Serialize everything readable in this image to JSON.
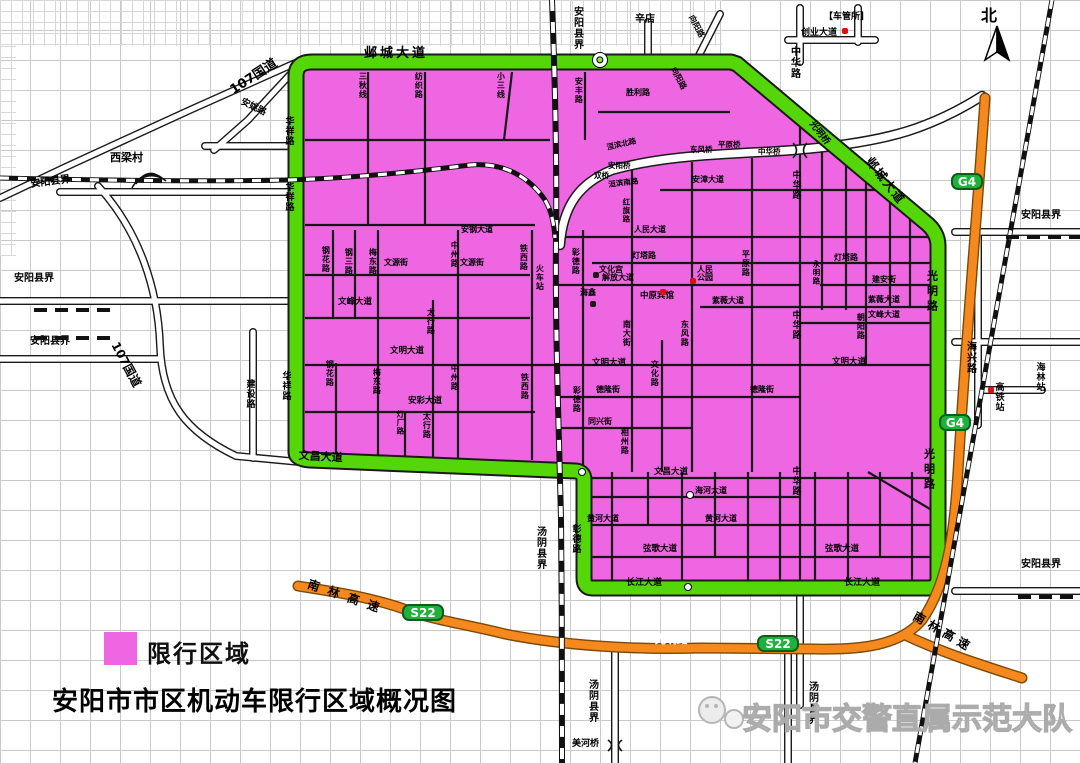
{
  "page": {
    "title": "安阳市市区机动车限行区域概况图",
    "legend_label": "限行区域",
    "watermark": "安阳市交警直属示范大队"
  },
  "colors": {
    "restricted_zone": "#ee66e2",
    "boundary_road_green": "#55d608",
    "highway_orange": "#f6891e",
    "badge_green": "#1eb23c",
    "railway_black": "#111111",
    "grid_gray": "#c9c9c9",
    "poi_red": "#dd1111"
  },
  "map": {
    "labels": [
      {
        "t": "107国道",
        "x": 228,
        "y": 86,
        "s": 13,
        "r": -33
      },
      {
        "t": "安姚路",
        "x": 243,
        "y": 98,
        "s": 9,
        "r": 26
      },
      {
        "t": "西梁村",
        "x": 110,
        "y": 152,
        "s": 11
      },
      {
        "t": "安阳县界",
        "x": 30,
        "y": 180,
        "s": 10,
        "r": -7
      },
      {
        "t": "安阳县界",
        "x": 14,
        "y": 274,
        "s": 10
      },
      {
        "t": "安阳县界",
        "x": 30,
        "y": 337,
        "s": 10
      },
      {
        "t": "安阳县界",
        "x": 571,
        "y": 6,
        "s": 10,
        "v": 1
      },
      {
        "t": "安阳县界",
        "x": 1021,
        "y": 211,
        "s": 10
      },
      {
        "t": "安阳县界",
        "x": 1021,
        "y": 560,
        "s": 10
      },
      {
        "t": "107国道",
        "x": 120,
        "y": 340,
        "s": 12,
        "r": 62
      },
      {
        "t": "建设路",
        "x": 244,
        "y": 379,
        "s": 9,
        "v": 1
      },
      {
        "t": "辛店",
        "x": 635,
        "y": 15,
        "s": 10
      },
      {
        "t": "【车管所】",
        "x": 824,
        "y": 13,
        "s": 9
      },
      {
        "t": "创业大道",
        "x": 801,
        "y": 29,
        "s": 9
      },
      {
        "t": "中华路",
        "x": 788,
        "y": 46,
        "s": 10,
        "v": 1
      },
      {
        "t": "北",
        "x": 981,
        "y": 8,
        "s": 16
      },
      {
        "t": "海兴路",
        "x": 964,
        "y": 341,
        "s": 10,
        "v": 1
      },
      {
        "t": "海林站",
        "x": 1034,
        "y": 362,
        "s": 9,
        "v": 1
      },
      {
        "t": "高铁站",
        "x": 993,
        "y": 382,
        "s": 9,
        "v": 1
      },
      {
        "t": "汤阴县界",
        "x": 534,
        "y": 526,
        "s": 10,
        "v": 1
      },
      {
        "t": "汤阴县界",
        "x": 586,
        "y": 679,
        "s": 10,
        "v": 1
      },
      {
        "t": "汤阴县界",
        "x": 806,
        "y": 681,
        "s": 10,
        "v": 1
      },
      {
        "t": "美河桥",
        "x": 572,
        "y": 740,
        "s": 9
      },
      {
        "t": "南林高速",
        "x": 310,
        "y": 578,
        "s": 12,
        "r": 19,
        "sp": 9
      },
      {
        "t": "南林高速",
        "x": 917,
        "y": 610,
        "s": 12,
        "r": 30,
        "sp": 5
      },
      {
        "t": "光明路",
        "x": 655,
        "y": 634,
        "s": 11,
        "c": "#ffffff"
      },
      {
        "t": "邺城大道",
        "x": 364,
        "y": 47,
        "s": 13,
        "sp": 3
      },
      {
        "t": "邺城大道",
        "x": 873,
        "y": 155,
        "s": 12,
        "r": 52,
        "sp": 2
      },
      {
        "t": "光明桥",
        "x": 814,
        "y": 120,
        "s": 9,
        "r": 52
      },
      {
        "t": "光明路",
        "x": 926,
        "y": 270,
        "s": 11,
        "v": 1,
        "sp": 4
      },
      {
        "t": "光明路",
        "x": 923,
        "y": 448,
        "s": 11,
        "v": 1,
        "sp": 4
      },
      {
        "t": "华祥路",
        "x": 283,
        "y": 116,
        "s": 9,
        "v": 1
      },
      {
        "t": "华祥路",
        "x": 283,
        "y": 182,
        "s": 9,
        "v": 1
      },
      {
        "t": "华祥路",
        "x": 280,
        "y": 371,
        "s": 9,
        "v": 1
      },
      {
        "t": "文昌大道",
        "x": 299,
        "y": 450,
        "s": 11,
        "r": 3
      },
      {
        "t": "长江大道",
        "x": 626,
        "y": 579,
        "s": 9
      },
      {
        "t": "长江大道",
        "x": 844,
        "y": 579,
        "s": 9
      },
      {
        "t": "彰德路",
        "x": 570,
        "y": 524,
        "s": 9,
        "v": 1
      },
      {
        "t": "三秋线",
        "x": 358,
        "y": 72,
        "v": 1
      },
      {
        "t": "纺织路",
        "x": 414,
        "y": 72,
        "v": 1
      },
      {
        "t": "小三线",
        "x": 496,
        "y": 72,
        "v": 1
      },
      {
        "t": "安丰路",
        "x": 574,
        "y": 77,
        "v": 1
      },
      {
        "t": "胜利路",
        "x": 626,
        "y": 89
      },
      {
        "t": "向阳路",
        "x": 694,
        "y": 14,
        "r": 62
      },
      {
        "t": "向阳路",
        "x": 676,
        "y": 66,
        "r": 62
      },
      {
        "t": "洹滨北路",
        "x": 606,
        "y": 144,
        "r": -13,
        "s": 7.5
      },
      {
        "t": "东风桥",
        "x": 690,
        "y": 146,
        "s": 7.5
      },
      {
        "t": "平原桥",
        "x": 718,
        "y": 141,
        "s": 7.5
      },
      {
        "t": "中华桥",
        "x": 758,
        "y": 148,
        "s": 7.5
      },
      {
        "t": "安阳桥",
        "x": 608,
        "y": 162,
        "s": 7.5
      },
      {
        "t": "双桥",
        "x": 594,
        "y": 172,
        "s": 7.5
      },
      {
        "t": "洹滨南路",
        "x": 608,
        "y": 181,
        "r": -7,
        "s": 7.5
      },
      {
        "t": "安漳大道",
        "x": 692,
        "y": 176
      },
      {
        "t": "中华路",
        "x": 790,
        "y": 170,
        "v": 1,
        "s": 9
      },
      {
        "t": "中华路",
        "x": 790,
        "y": 310,
        "v": 1,
        "s": 9
      },
      {
        "t": "中华路",
        "x": 790,
        "y": 466,
        "v": 1,
        "s": 9
      },
      {
        "t": "红旗路",
        "x": 622,
        "y": 198,
        "v": 1,
        "s": 7.5
      },
      {
        "t": "平原路",
        "x": 741,
        "y": 250,
        "v": 1
      },
      {
        "t": "人民大道",
        "x": 634,
        "y": 226
      },
      {
        "t": "安钢大道",
        "x": 461,
        "y": 226
      },
      {
        "t": "灯塔路",
        "x": 632,
        "y": 252
      },
      {
        "t": "灯塔路",
        "x": 834,
        "y": 254
      },
      {
        "t": "解放大道",
        "x": 602,
        "y": 274
      },
      {
        "t": "文化宫",
        "x": 599,
        "y": 266
      },
      {
        "t": "海鑫",
        "x": 580,
        "y": 289
      },
      {
        "t": "中原宾馆",
        "x": 640,
        "y": 292,
        "s": 8.5
      },
      {
        "t": "人民公园",
        "x": 697,
        "y": 266,
        "w": 20
      },
      {
        "t": "建安街",
        "x": 872,
        "y": 276
      },
      {
        "t": "永明路",
        "x": 812,
        "y": 260,
        "v": 1,
        "s": 7.5
      },
      {
        "t": "紫薇大道",
        "x": 712,
        "y": 297
      },
      {
        "t": "紫薇大道",
        "x": 868,
        "y": 296
      },
      {
        "t": "文源街",
        "x": 384,
        "y": 259
      },
      {
        "t": "文源街",
        "x": 460,
        "y": 259
      },
      {
        "t": "中州路",
        "x": 450,
        "y": 241,
        "v": 1
      },
      {
        "t": "中州路",
        "x": 450,
        "y": 364,
        "v": 1
      },
      {
        "t": "太行路",
        "x": 426,
        "y": 308,
        "v": 1
      },
      {
        "t": "太行路",
        "x": 422,
        "y": 412,
        "v": 1
      },
      {
        "t": "梅东路",
        "x": 368,
        "y": 248,
        "v": 1
      },
      {
        "t": "梅东路",
        "x": 372,
        "y": 368,
        "v": 1
      },
      {
        "t": "钢三路",
        "x": 344,
        "y": 248,
        "v": 1
      },
      {
        "t": "钢花路",
        "x": 321,
        "y": 246,
        "v": 1
      },
      {
        "t": "钢花路",
        "x": 325,
        "y": 360,
        "v": 1
      },
      {
        "t": "灯厂路",
        "x": 396,
        "y": 410,
        "v": 1,
        "s": 7.5
      },
      {
        "t": "铁西路",
        "x": 519,
        "y": 244,
        "v": 1
      },
      {
        "t": "铁西路",
        "x": 520,
        "y": 373,
        "v": 1
      },
      {
        "t": "火车站",
        "x": 535,
        "y": 264,
        "v": 1
      },
      {
        "t": "文峰大道",
        "x": 338,
        "y": 298,
        "s": 8.5
      },
      {
        "t": "文峰大道",
        "x": 868,
        "y": 311
      },
      {
        "t": "文明大道",
        "x": 390,
        "y": 347,
        "s": 8.5
      },
      {
        "t": "文明大道",
        "x": 592,
        "y": 359,
        "s": 8.5
      },
      {
        "t": "文明大道",
        "x": 832,
        "y": 358,
        "s": 8.5
      },
      {
        "t": "安彩大道",
        "x": 408,
        "y": 397,
        "s": 8.5
      },
      {
        "t": "德隆街",
        "x": 596,
        "y": 386
      },
      {
        "t": "德隆街",
        "x": 750,
        "y": 386
      },
      {
        "t": "同兴街",
        "x": 588,
        "y": 418
      },
      {
        "t": "相州路",
        "x": 620,
        "y": 428,
        "v": 1
      },
      {
        "t": "文化路",
        "x": 650,
        "y": 360,
        "v": 1
      },
      {
        "t": "南大街",
        "x": 622,
        "y": 320,
        "v": 1
      },
      {
        "t": "东风路",
        "x": 680,
        "y": 320,
        "v": 1
      },
      {
        "t": "朝阳路",
        "x": 856,
        "y": 313,
        "v": 1
      },
      {
        "t": "彰德路",
        "x": 571,
        "y": 248,
        "v": 1
      },
      {
        "t": "彰德路",
        "x": 572,
        "y": 386,
        "v": 1
      },
      {
        "t": "文昌大道",
        "x": 654,
        "y": 468,
        "s": 8.5
      },
      {
        "t": "海河大道",
        "x": 695,
        "y": 487
      },
      {
        "t": "黄河大道",
        "x": 587,
        "y": 515
      },
      {
        "t": "黄河大道",
        "x": 705,
        "y": 515
      },
      {
        "t": "弦歌大道",
        "x": 643,
        "y": 545,
        "s": 8.5
      },
      {
        "t": "弦歌大道",
        "x": 825,
        "y": 545,
        "s": 8.5
      }
    ],
    "badges": [
      {
        "t": "G4",
        "x": 951,
        "y": 173,
        "w": 32
      },
      {
        "t": "G4",
        "x": 939,
        "y": 414,
        "w": 32
      },
      {
        "t": "S22",
        "x": 402,
        "y": 604,
        "w": 42
      },
      {
        "t": "S22",
        "x": 757,
        "y": 635,
        "w": 42
      }
    ],
    "pois": [
      {
        "x": 593,
        "y": 272,
        "c": "#1a1a1a"
      },
      {
        "x": 590,
        "y": 301,
        "c": "#1a1a1a"
      },
      {
        "x": 660,
        "y": 289,
        "c": "#dd1111"
      },
      {
        "x": 690,
        "y": 278,
        "c": "#dd1111"
      },
      {
        "x": 842,
        "y": 28,
        "c": "#dd1111"
      },
      {
        "x": 988,
        "y": 387,
        "c": "#dd1111"
      }
    ],
    "roundabouts": [
      {
        "x": 600,
        "y": 60,
        "r": 8,
        "d": 1
      },
      {
        "x": 582,
        "y": 472,
        "r": 4
      },
      {
        "x": 690,
        "y": 495,
        "r": 4
      },
      {
        "x": 688,
        "y": 587,
        "r": 4
      }
    ],
    "border_dashes": [
      {
        "x": 34,
        "y": 299
      },
      {
        "x": 34,
        "y": 327
      },
      {
        "x": 1006,
        "y": 226
      },
      {
        "x": 1018,
        "y": 586
      }
    ]
  }
}
